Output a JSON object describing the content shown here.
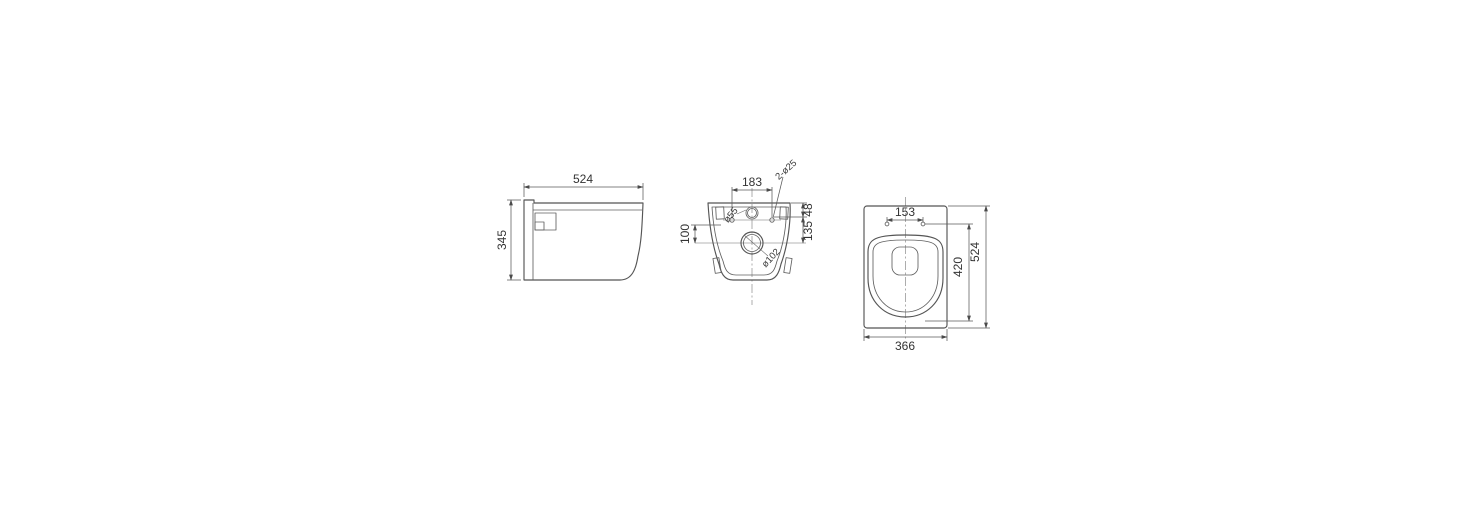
{
  "meta": {
    "type": "technical drawing - wall hung toilet dimensions",
    "line_color": "#555555",
    "text_color": "#333333",
    "background": "#ffffff"
  },
  "views": {
    "side": {
      "label": "side view",
      "width": "524",
      "height": "345"
    },
    "rear": {
      "label": "rear installation view",
      "bolt_spacing": "183",
      "inlet_offset": "100",
      "top_to_bolts": "48",
      "top_to_outlet": "135",
      "bolt_holes": "2-ø25",
      "inlet_diameter": "ø55",
      "outlet_diameter": "ø102"
    },
    "top": {
      "label": "top view",
      "hinge_spacing": "153",
      "bowl_length": "420",
      "total_depth": "524",
      "width": "366"
    }
  }
}
